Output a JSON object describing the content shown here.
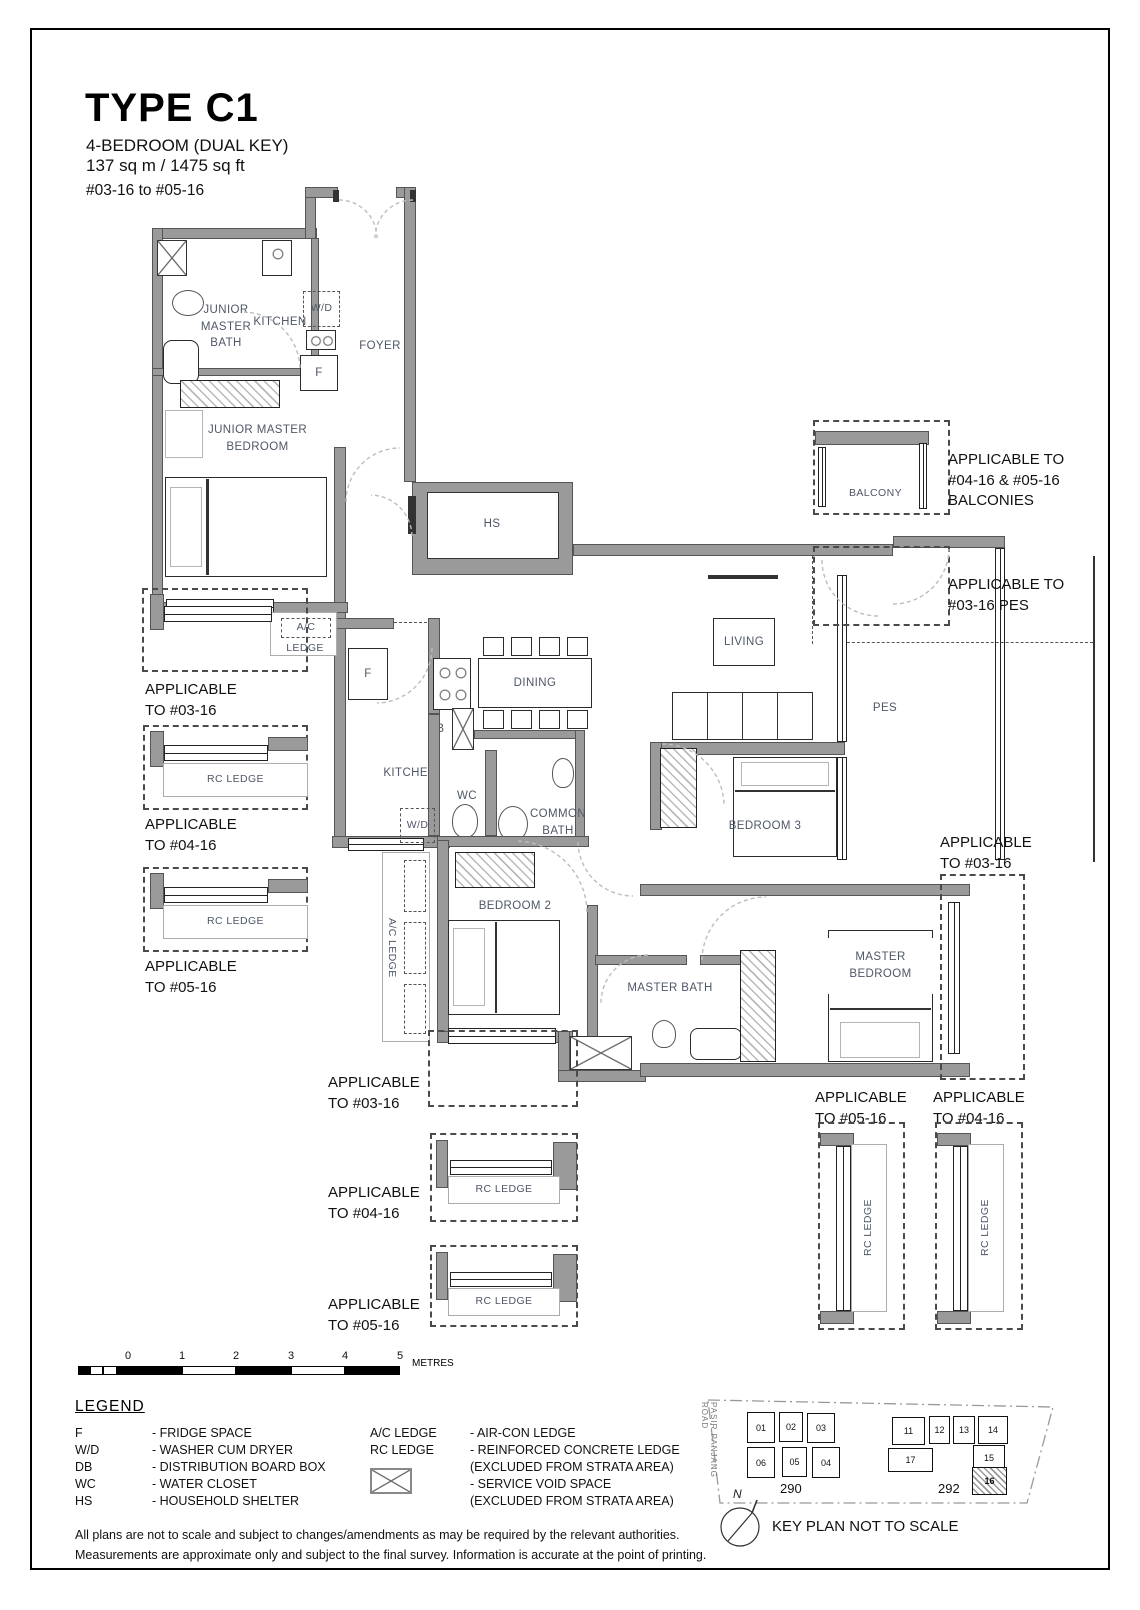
{
  "title": {
    "type": "TYPE C1",
    "subtitle1": "4-BEDROOM (DUAL KEY)",
    "subtitle2": "137 sq m / 1475 sq ft",
    "units": "#03-16 to #05-16"
  },
  "rooms": {
    "junior_master_bath": "JUNIOR\nMASTER\nBATH",
    "kitchen_1": "KITCHEN",
    "wd_1": "W/D",
    "fridge_1": "F",
    "foyer": "FOYER",
    "junior_master_bedroom": "JUNIOR MASTER\nBEDROOM",
    "hs": "HS",
    "balcony": "BALCONY",
    "ac_ledge_line1": "A/C",
    "ac_ledge_line2": "LEDGE",
    "living": "LIVING",
    "dining": "DINING",
    "pes": "PES",
    "fridge_2": "F",
    "db": "DB",
    "kitchen_2": "KITCHEN",
    "wc": "WC",
    "common_bath": "COMMON\nBATH",
    "wd_2": "W/D",
    "bedroom_3": "BEDROOM 3",
    "bedroom_2": "BEDROOM 2",
    "ac_ledge_side": "A/C LEDGE",
    "master_bath": "MASTER BATH",
    "master_bedroom": "MASTER\nBEDROOM",
    "rc_ledge": "RC LEDGE"
  },
  "annotations": {
    "balconies": "APPLICABLE TO\n#04-16 & #05-16\nBALCONIES",
    "pes_03": "APPLICABLE TO\n#03-16 PES",
    "left_03": "APPLICABLE\nTO #03-16",
    "left_04": "APPLICABLE\nTO #04-16",
    "left_05": "APPLICABLE\nTO #05-16",
    "right_03": "APPLICABLE\nTO #03-16",
    "bottom_03": "APPLICABLE\nTO #03-16",
    "bottom_04": "APPLICABLE\nTO #04-16",
    "bottom_05": "APPLICABLE\nTO #05-16",
    "br_05": "APPLICABLE\nTO #05-16",
    "br_04": "APPLICABLE\nTO #04-16"
  },
  "scale_bar": {
    "ticks": [
      "0",
      "1",
      "2",
      "3",
      "4",
      "5"
    ],
    "unit": "METRES"
  },
  "legend": {
    "heading": "LEGEND",
    "items_left": [
      {
        "t": "F",
        "d": "- FRIDGE SPACE"
      },
      {
        "t": "W/D",
        "d": "- WASHER CUM DRYER"
      },
      {
        "t": "DB",
        "d": "- DISTRIBUTION BOARD BOX"
      },
      {
        "t": "WC",
        "d": "- WATER CLOSET"
      },
      {
        "t": "HS",
        "d": "- HOUSEHOLD SHELTER"
      }
    ],
    "items_right": [
      {
        "t": "A/C LEDGE",
        "d": "- AIR-CON LEDGE"
      },
      {
        "t": "RC LEDGE",
        "d": "- REINFORCED CONCRETE LEDGE"
      },
      {
        "t": "",
        "d": "(EXCLUDED FROM STRATA AREA)"
      },
      {
        "t": "",
        "d": "- SERVICE VOID SPACE"
      },
      {
        "t": "",
        "d": "(EXCLUDED FROM STRATA AREA)"
      }
    ]
  },
  "key_plan": {
    "road": "PASIR PANJANG ROAD",
    "blocks": [
      "01",
      "02",
      "03",
      "06",
      "05",
      "04",
      "11",
      "12",
      "13",
      "14",
      "17",
      "15",
      "16"
    ],
    "building_290": "290",
    "building_292": "292",
    "highlighted_block": "16",
    "north": "N",
    "caption": "KEY PLAN NOT TO SCALE"
  },
  "disclaimer": {
    "line1": "All plans are not to scale and subject to changes/amendments as may be required by the relevant authorities.",
    "line2": "Measurements are approximate only and subject to the final survey. Information is accurate at the point of printing."
  },
  "colors": {
    "wall_gray": "#9a9a9a",
    "label_blue_gray": "#4e5766",
    "annotation_black": "#111111"
  }
}
